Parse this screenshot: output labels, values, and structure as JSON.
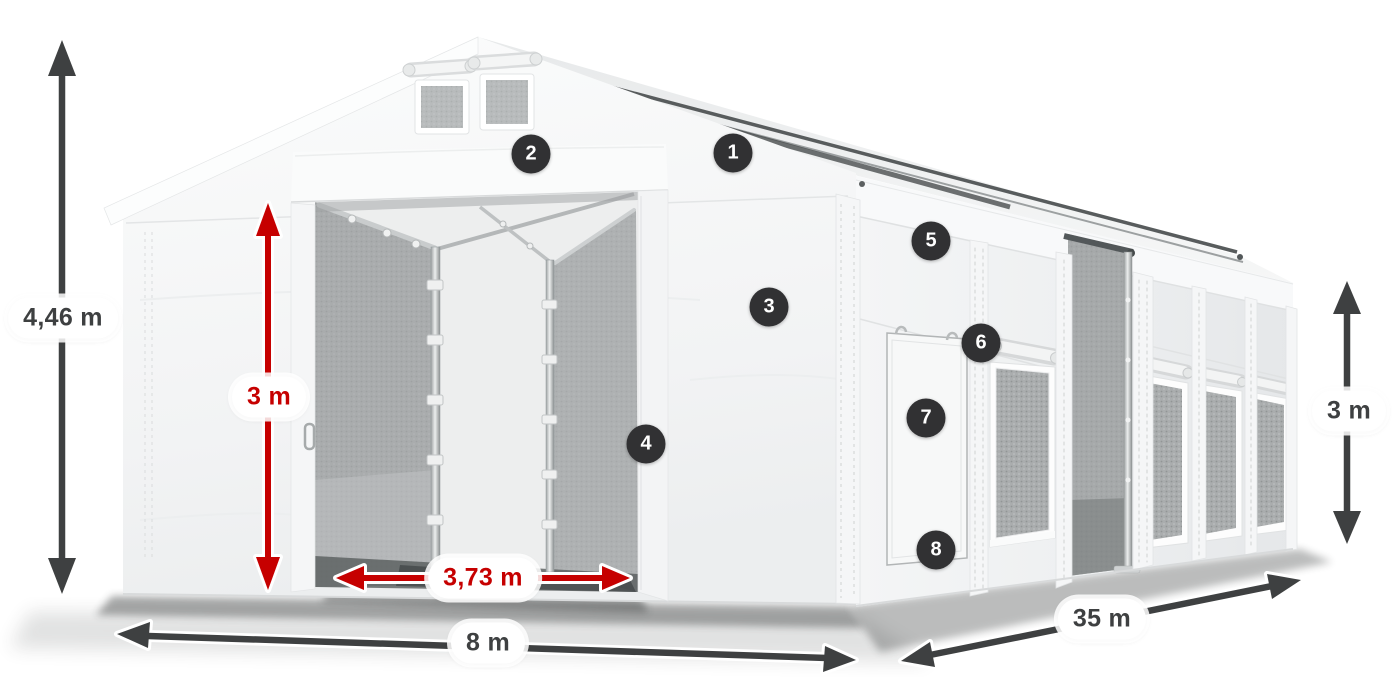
{
  "diagram": {
    "alt": "Three-quarter view of a white PVC storage tent with open gable entrance, numbered part callouts 1-8 and dimension arrows",
    "dimensions": {
      "total_height": "4,46 m",
      "entrance_height": "3 m",
      "entrance_width": "3,73 m",
      "width": "8 m",
      "length": "35 m",
      "side_height": "3 m"
    },
    "callouts": [
      {
        "number": "1"
      },
      {
        "number": "2"
      },
      {
        "number": "3"
      },
      {
        "number": "4"
      },
      {
        "number": "5"
      },
      {
        "number": "6"
      },
      {
        "number": "7"
      },
      {
        "number": "8"
      }
    ],
    "colors": {
      "canvas_bg": "#ffffff",
      "dimension_arrow_gray": "#3e4041",
      "dimension_highlight_red": "#c60000",
      "callout_badge_bg": "#313133",
      "callout_badge_text": "#ffffff",
      "tent_fabric": "#f4f5f6"
    }
  }
}
